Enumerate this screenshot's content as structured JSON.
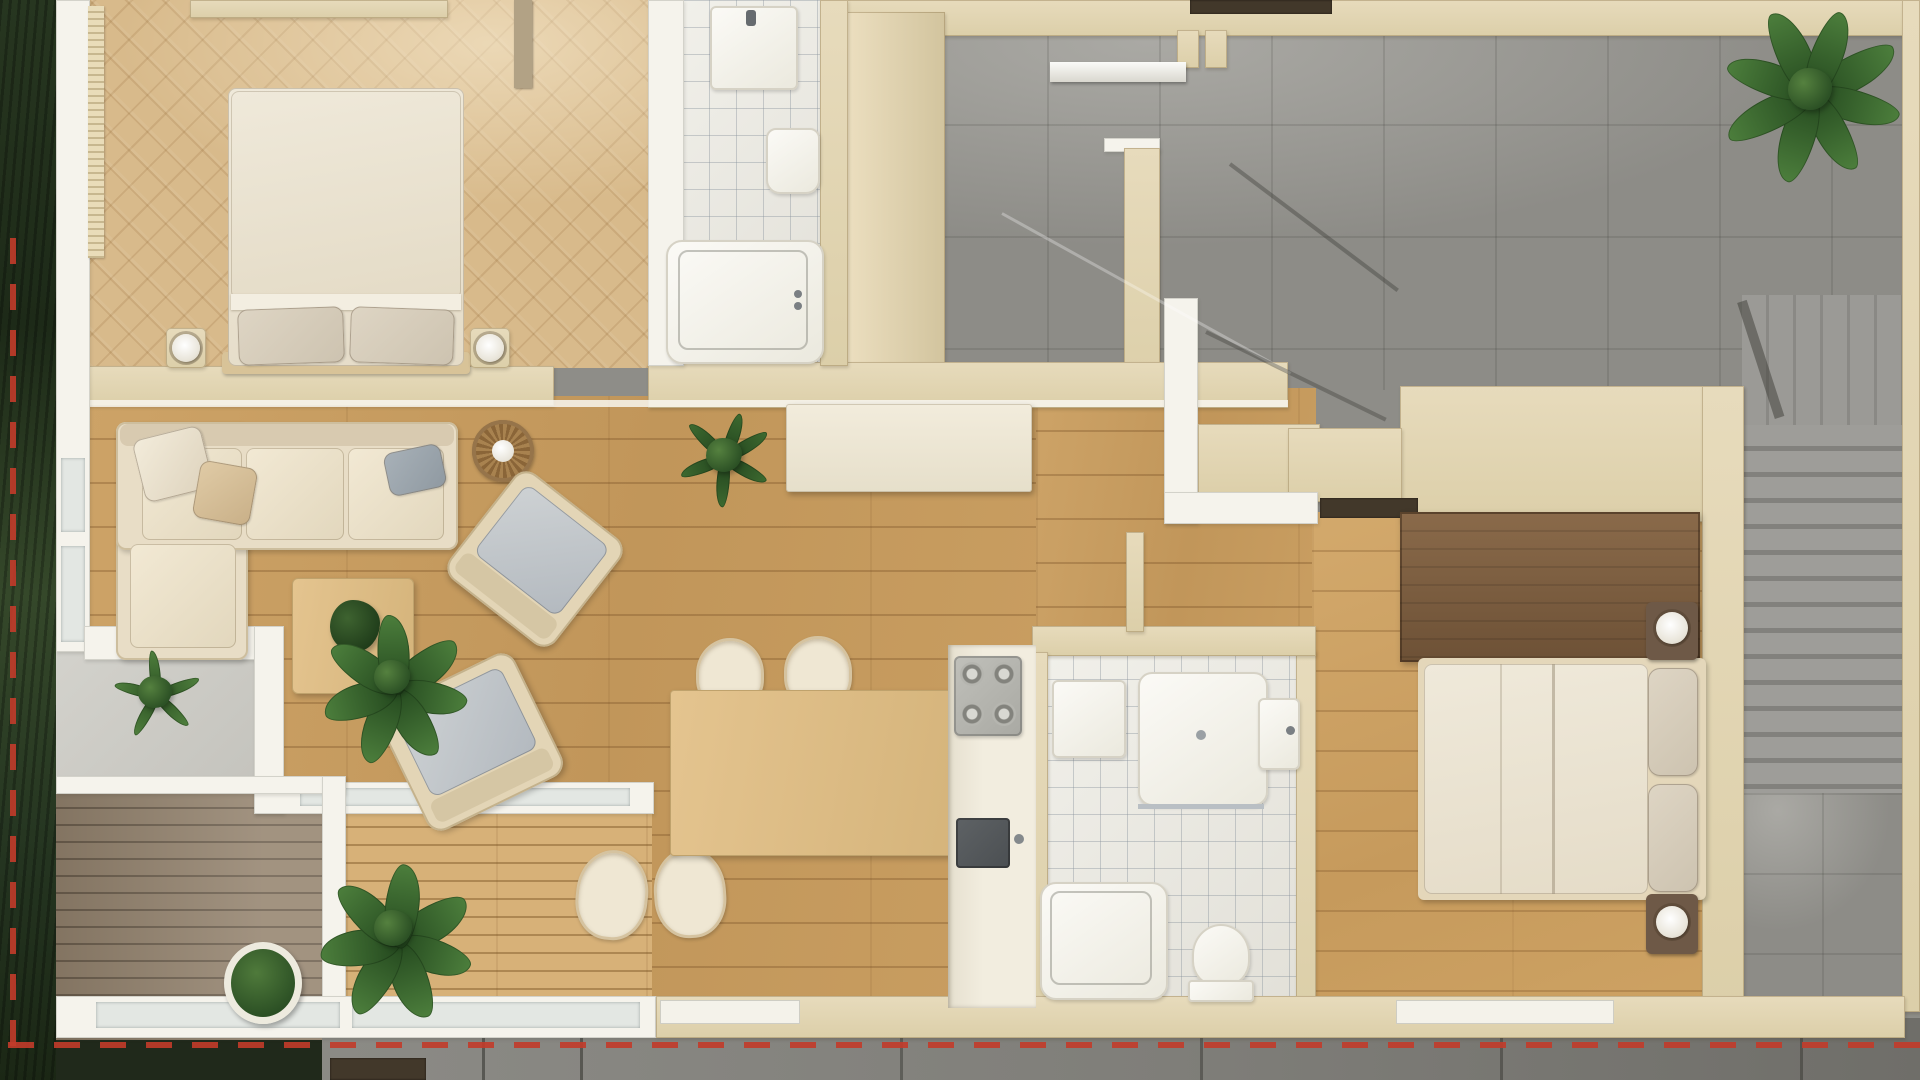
{
  "meta": {
    "title": "apartment-floor-plan-top-view-render",
    "width_px": 1920,
    "height_px": 1080,
    "visible_text": "none"
  },
  "palette": {
    "lawn_green": "#273620",
    "boundary_red": "#c23b2a",
    "wall_beige": "#e6dabb",
    "wall_white": "#f5f3ec",
    "oak_floor": "#c99f63",
    "parquet_herringbone": "#d8ba8b",
    "tile_white": "#edebe5",
    "concrete_gray": "#9a9994",
    "deck_wood": "#93826e",
    "terrace_wood": "#d4ad74",
    "sofa_beige": "#e8ddc6",
    "cushion_gray": "#c0c6ca",
    "walnut_dark": "#7c5e40",
    "bedding_cream": "#ece5d6",
    "plant_green": "#3c6a33",
    "sink_anthracite": "#575b5e"
  },
  "scene": {
    "outdoor": {
      "lawn_strip": "left edge",
      "boundary_marker": "red dashed property line (left + bottom)",
      "walkway": "concrete path along bottom",
      "deck": "weathered plank deck, bottom-left",
      "terrace": "pine plank terrace next to deck"
    },
    "rooms": [
      {
        "name": "bedroom-1",
        "floor": "herringbone parquet",
        "furniture": [
          "double bed",
          "2 nightstands",
          "2 round lamps",
          "dresser",
          "radiator"
        ]
      },
      {
        "name": "bathroom-1",
        "floor": "white tile",
        "fixtures": [
          "washbasin",
          "toilet",
          "bathtub"
        ]
      },
      {
        "name": "living-dining",
        "floor": "oak planks",
        "furniture": [
          "L-shaped sofa",
          "2 armchairs",
          "coffee table",
          "round rattan wall clock",
          "dining table",
          "4 chairs",
          "white sideboard"
        ]
      },
      {
        "name": "kitchen",
        "fixtures": [
          "counter run",
          "4-burner cooktop",
          "anthracite sink"
        ]
      },
      {
        "name": "bathroom-2",
        "floor": "white tile",
        "fixtures": [
          "vanity",
          "shower tray",
          "bathtub",
          "toilet",
          "washbasin"
        ]
      },
      {
        "name": "bedroom-2",
        "floor": "oak planks",
        "furniture": [
          "double bed",
          "2 nightstands",
          "2 round lamps",
          "dark wardrobe"
        ]
      },
      {
        "name": "garage-courtyard",
        "floor": "large concrete tiles",
        "detail": "ramp shadows, door opening top"
      },
      {
        "name": "staircase",
        "detail": "straight stair run, right side"
      }
    ],
    "plants_count": 7
  }
}
